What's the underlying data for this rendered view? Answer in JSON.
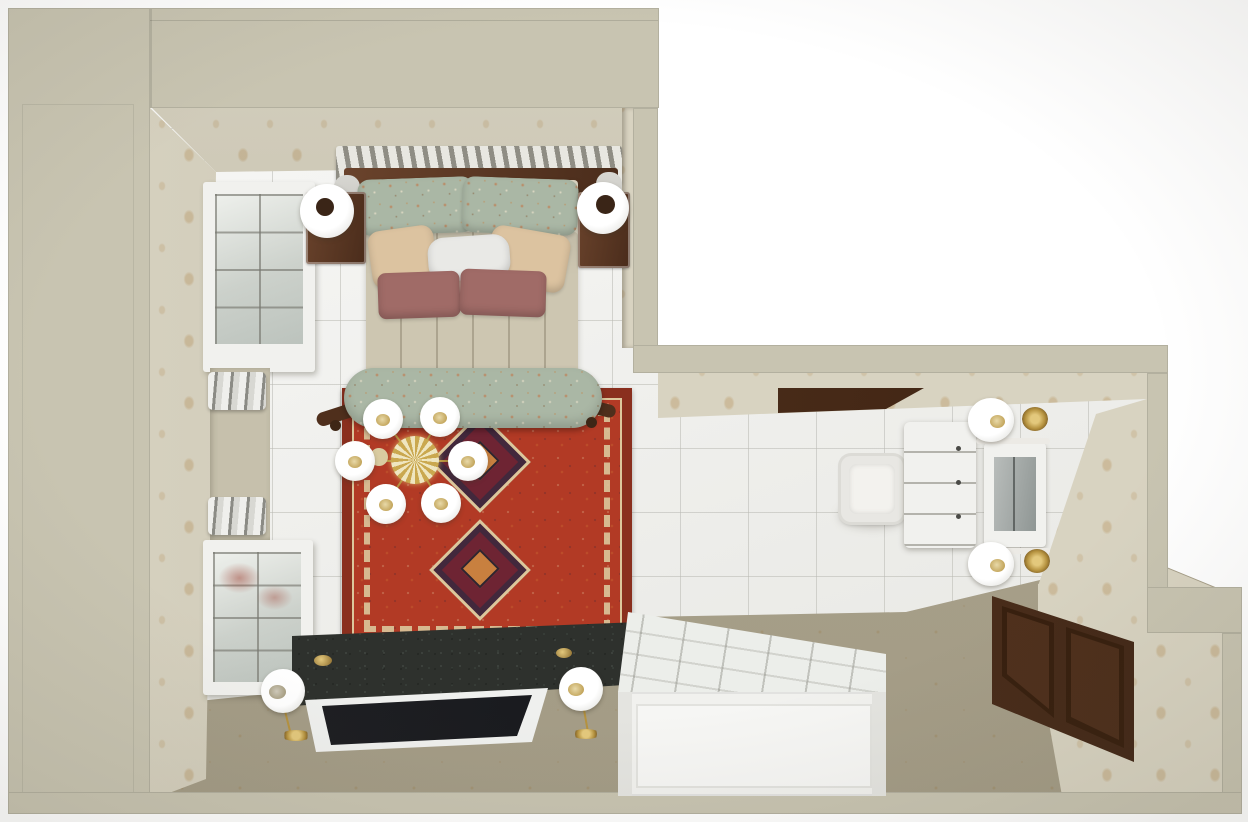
{
  "scene": {
    "title": "Top-down 3D render of a bedroom with dressing area",
    "rooms": [
      {
        "name": "bedroom"
      },
      {
        "name": "dressing-area"
      }
    ],
    "furniture": {
      "bed": "Double bed with floral, beige, white and mauve pillows",
      "radiator": "Radiator at head of bed",
      "headboard": "Dark wood headboard",
      "nightstand_left": "Left nightstand with round lamp",
      "nightstand_right": "Right nightstand with round lamp",
      "wardrobe_upper": "White glass-front wardrobe (upper left)",
      "linen_niche": "Open niche with folded linens",
      "wardrobe_lower": "White glass-front wardrobe (lower left)",
      "bench": "Floral upholstered bench at foot of bed",
      "rug": "Red oriental area rug with diamond medallions",
      "chandelier": "Six-globe brass ceiling chandelier",
      "media_console": "Black granite-top media console",
      "tv": "Flat-screen television",
      "floor_lamp_left": "Globe floor lamp",
      "floor_lamp_right": "Globe floor lamp",
      "white_wardrobe": "White paneled wardrobe",
      "door": "Open dark wood door",
      "vanity_chair": "Ornate white vanity chair",
      "vanity": "White dressing table",
      "mirror": "Framed vanity mirror",
      "sconce_top": "Globe wall sconce",
      "sconce_bottom": "Globe wall sconce",
      "dark_wardrobe": "Dark wood paneled wardrobe"
    }
  },
  "palette": {
    "wall": "#c8c4b1",
    "wallDark": "#b1ad99",
    "paper": "#d8d3c1",
    "paperMotif": "#c2a87e",
    "tile": "#f3f3f0",
    "tileLine": "#dedad2",
    "carpet": "#b3ab94",
    "carpetMotif": "#9c8459",
    "granite": "#2e312d",
    "woodDark": "#4a2c1b",
    "woodMid": "#6a432c",
    "whiteFurn": "#f1f1ee",
    "sage": "#aab7a5",
    "rugRed": "#b23a25",
    "rugBorder": "#8a2f1e",
    "rugCream": "#dcc79c",
    "rugDark": "#3a2b3a",
    "gold": "#b5923f",
    "mauve": "#a06b67",
    "beigePillow": "#dcc3a0",
    "screen": "#17181c",
    "glass": "#a8adaa",
    "linen": "#e9e9e6"
  }
}
